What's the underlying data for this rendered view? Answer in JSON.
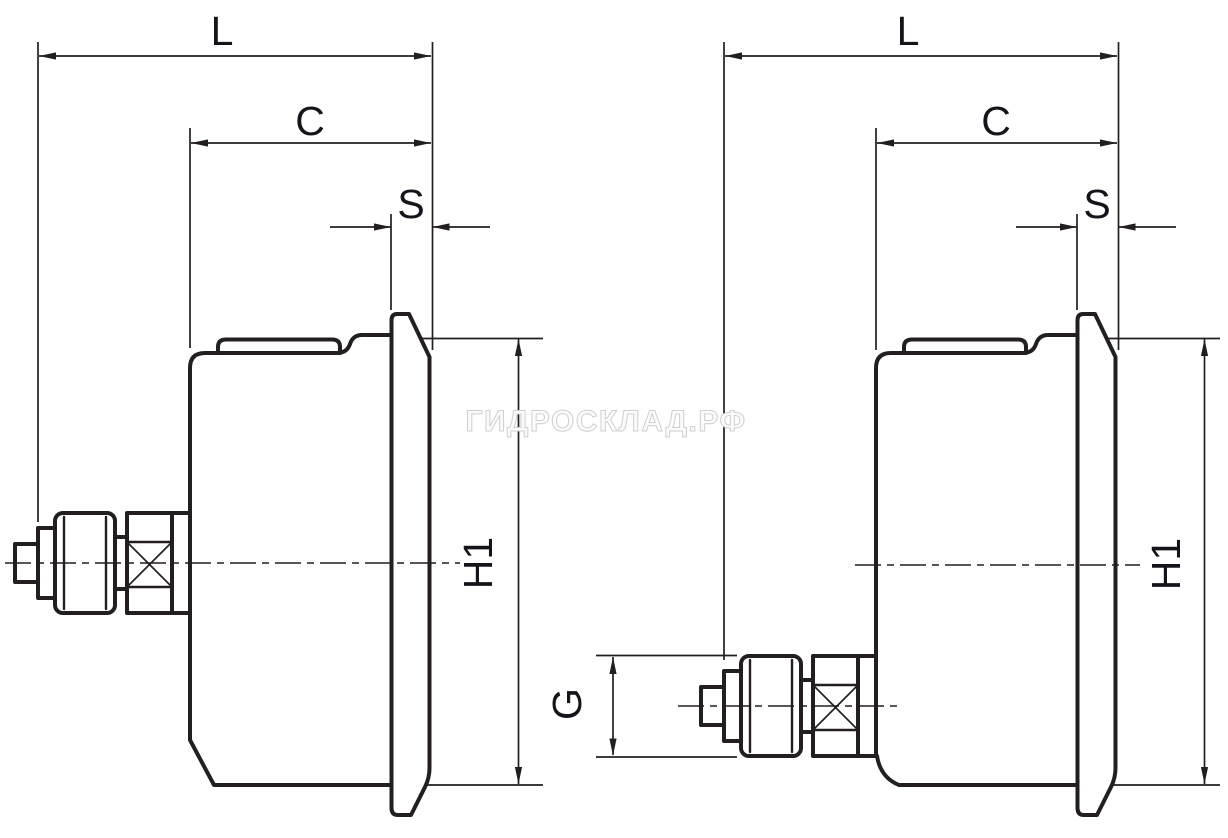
{
  "diagram": {
    "watermark": "ГИДРОСКЛАД.РФ",
    "colors": {
      "line": "#231f20",
      "background": "#ffffff",
      "watermark_outline": "#cfcfcf"
    },
    "views": [
      {
        "dims": {
          "L": "L",
          "C": "C",
          "S": "S",
          "H1": "H1"
        }
      },
      {
        "dims": {
          "L": "L",
          "C": "C",
          "S": "S",
          "H1": "H1",
          "G": "G"
        }
      }
    ]
  }
}
